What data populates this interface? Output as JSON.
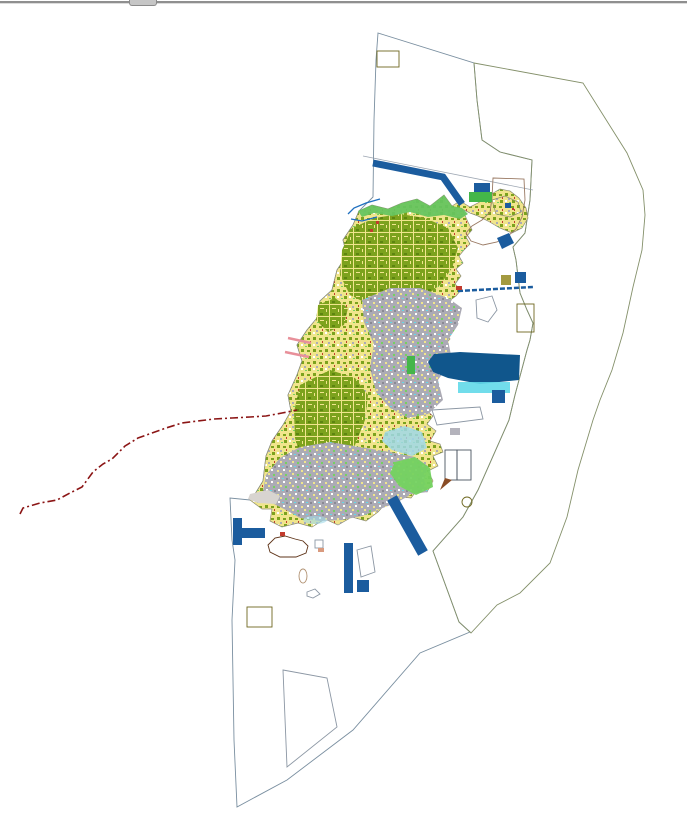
{
  "chrome": {
    "top_border_color": "#8F8F8F",
    "drag_tab_color": "#C6C6C6"
  },
  "map": {
    "background": "#FFFFFF",
    "palette": {
      "sea": "#6FEDF2",
      "east_zone": "#C9DB7C",
      "island_base": "#F0E58C",
      "forest": "#7CA21D",
      "forest_dark": "#5D8510",
      "urban": "#ACABB5",
      "urban_dark": "#8A8994",
      "light_green": "#74D260",
      "coastal_green": "#66C45F",
      "green_block": "#44B649",
      "shallow_blue": "#9FD8E8",
      "harbor_basin": "#62D9E9",
      "salmon": "#D99A7E",
      "navy": "#1B5C9E",
      "harbor_navy": "#10568C",
      "brown": "#8A4D26",
      "dark_khaki": "#A39A40",
      "pale_khaki": "#CFC66B",
      "white": "#FFFFFF",
      "red_speck": "#C23B2E",
      "pink_road": "#E8909A",
      "stream_blue": "#1F6FBF",
      "boundary_red": "#8B1515",
      "outline_gray": "#8C97A4",
      "flat_gray": "#D8D4D0"
    },
    "regions": [
      {
        "id": "planning-water-area",
        "fill_key": "sea"
      },
      {
        "id": "eastern-offshore-zone",
        "fill_key": "east_zone"
      },
      {
        "id": "island-landuse-mosaic",
        "fill_key": "island_base"
      },
      {
        "id": "forest-areas",
        "fill_key": "forest"
      },
      {
        "id": "urban-areas",
        "fill_key": "urban"
      },
      {
        "id": "green-space",
        "fill_key": "light_green"
      },
      {
        "id": "port-district",
        "fill_key": "salmon"
      },
      {
        "id": "harbor-structures",
        "fill_key": "navy"
      },
      {
        "id": "reclaimed-land",
        "fill_key": "brown"
      },
      {
        "id": "designated-plots",
        "fill_key": "dark_khaki"
      },
      {
        "id": "shallow-water",
        "fill_key": "shallow_blue"
      },
      {
        "id": "municipal-boundary",
        "fill_key": "boundary_red"
      }
    ]
  }
}
